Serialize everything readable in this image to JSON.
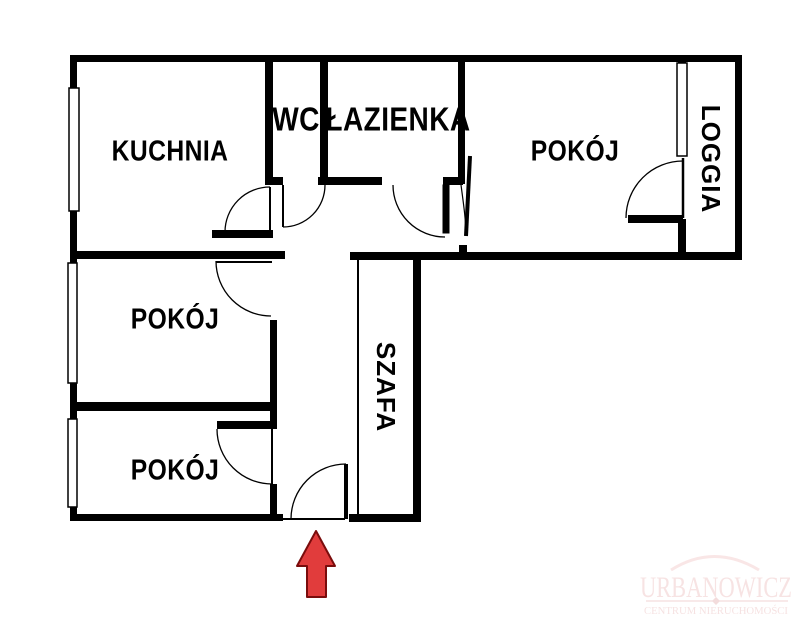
{
  "labels": {
    "kuchnia": "KUCHNIA",
    "wc": "WC",
    "lazienka": "ŁAZIENKA",
    "pokoj_top": "POKÓJ",
    "pokoj_middle": "POKÓJ",
    "pokoj_bottom": "POKÓJ",
    "loggia": "LOGGIA",
    "szafa": "SZAFA"
  },
  "watermark": {
    "name": "URBANOWICZ",
    "tagline": "CENTRUM NIERUCHOMOŚCI"
  },
  "colors": {
    "wall": "#000000",
    "background": "#ffffff",
    "arrow_fill": "#e13c3c",
    "arrow_outline": "#7a0c0c",
    "watermark_text": "#f7e3e3",
    "watermark_rule": "#f3dcdc"
  },
  "icons": {
    "entrance_arrow": "up-arrow"
  }
}
